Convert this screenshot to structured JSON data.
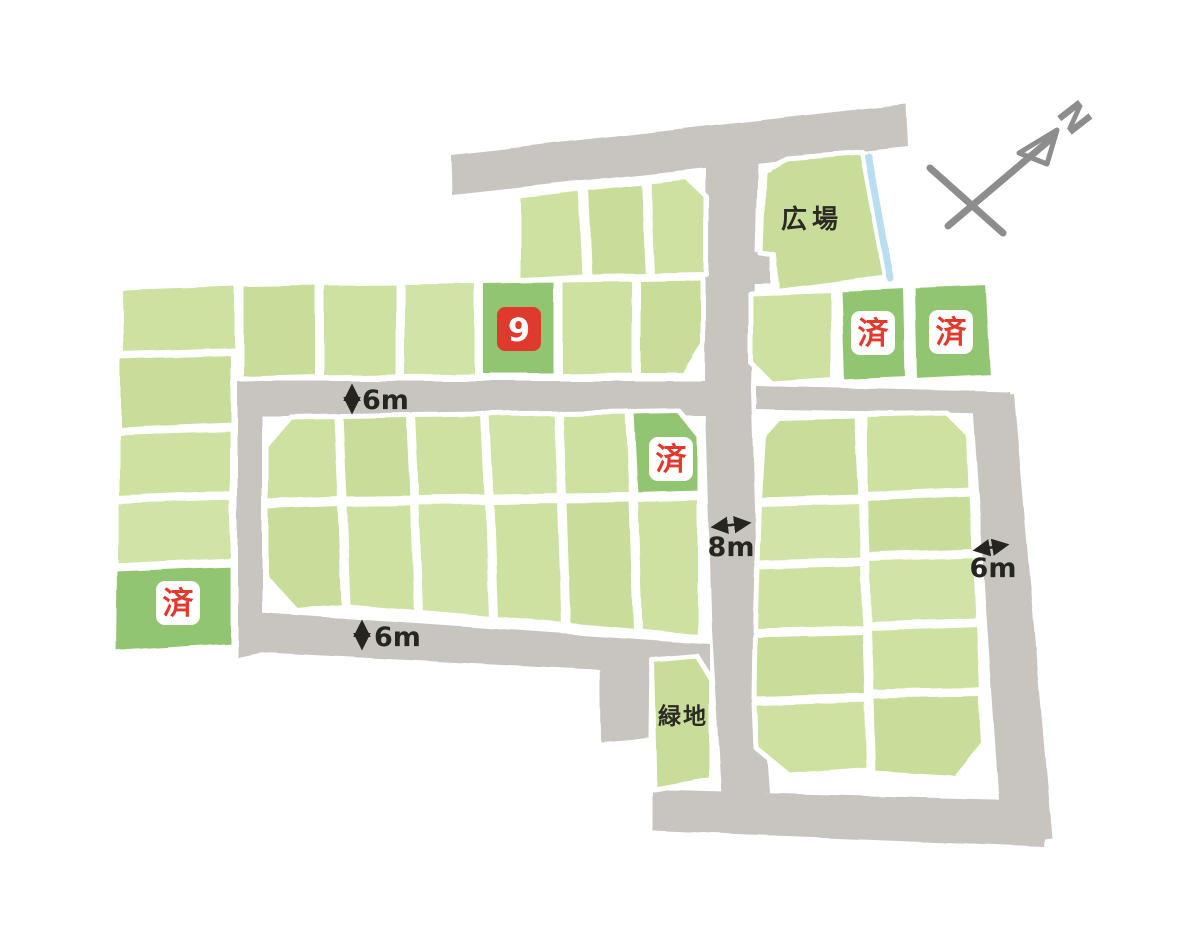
{
  "map": {
    "areas": {
      "plaza_label": "広場",
      "green_space_label": "緑地"
    },
    "plots": {
      "sold_label": "済",
      "featured_plot_number": "9"
    },
    "road_widths": {
      "west_road": "6m",
      "south_road": "6m",
      "main_road": "8m",
      "east_road": "6m"
    },
    "compass": {
      "north_label": "N"
    },
    "colors": {
      "plot_green": "#cde2a1",
      "plot_green_dark": "#92c571",
      "road_gray": "#c8c4c0",
      "accent_red": "#df3a2d",
      "stream_blue": "#b9ddf1",
      "ink": "#26251f"
    }
  }
}
